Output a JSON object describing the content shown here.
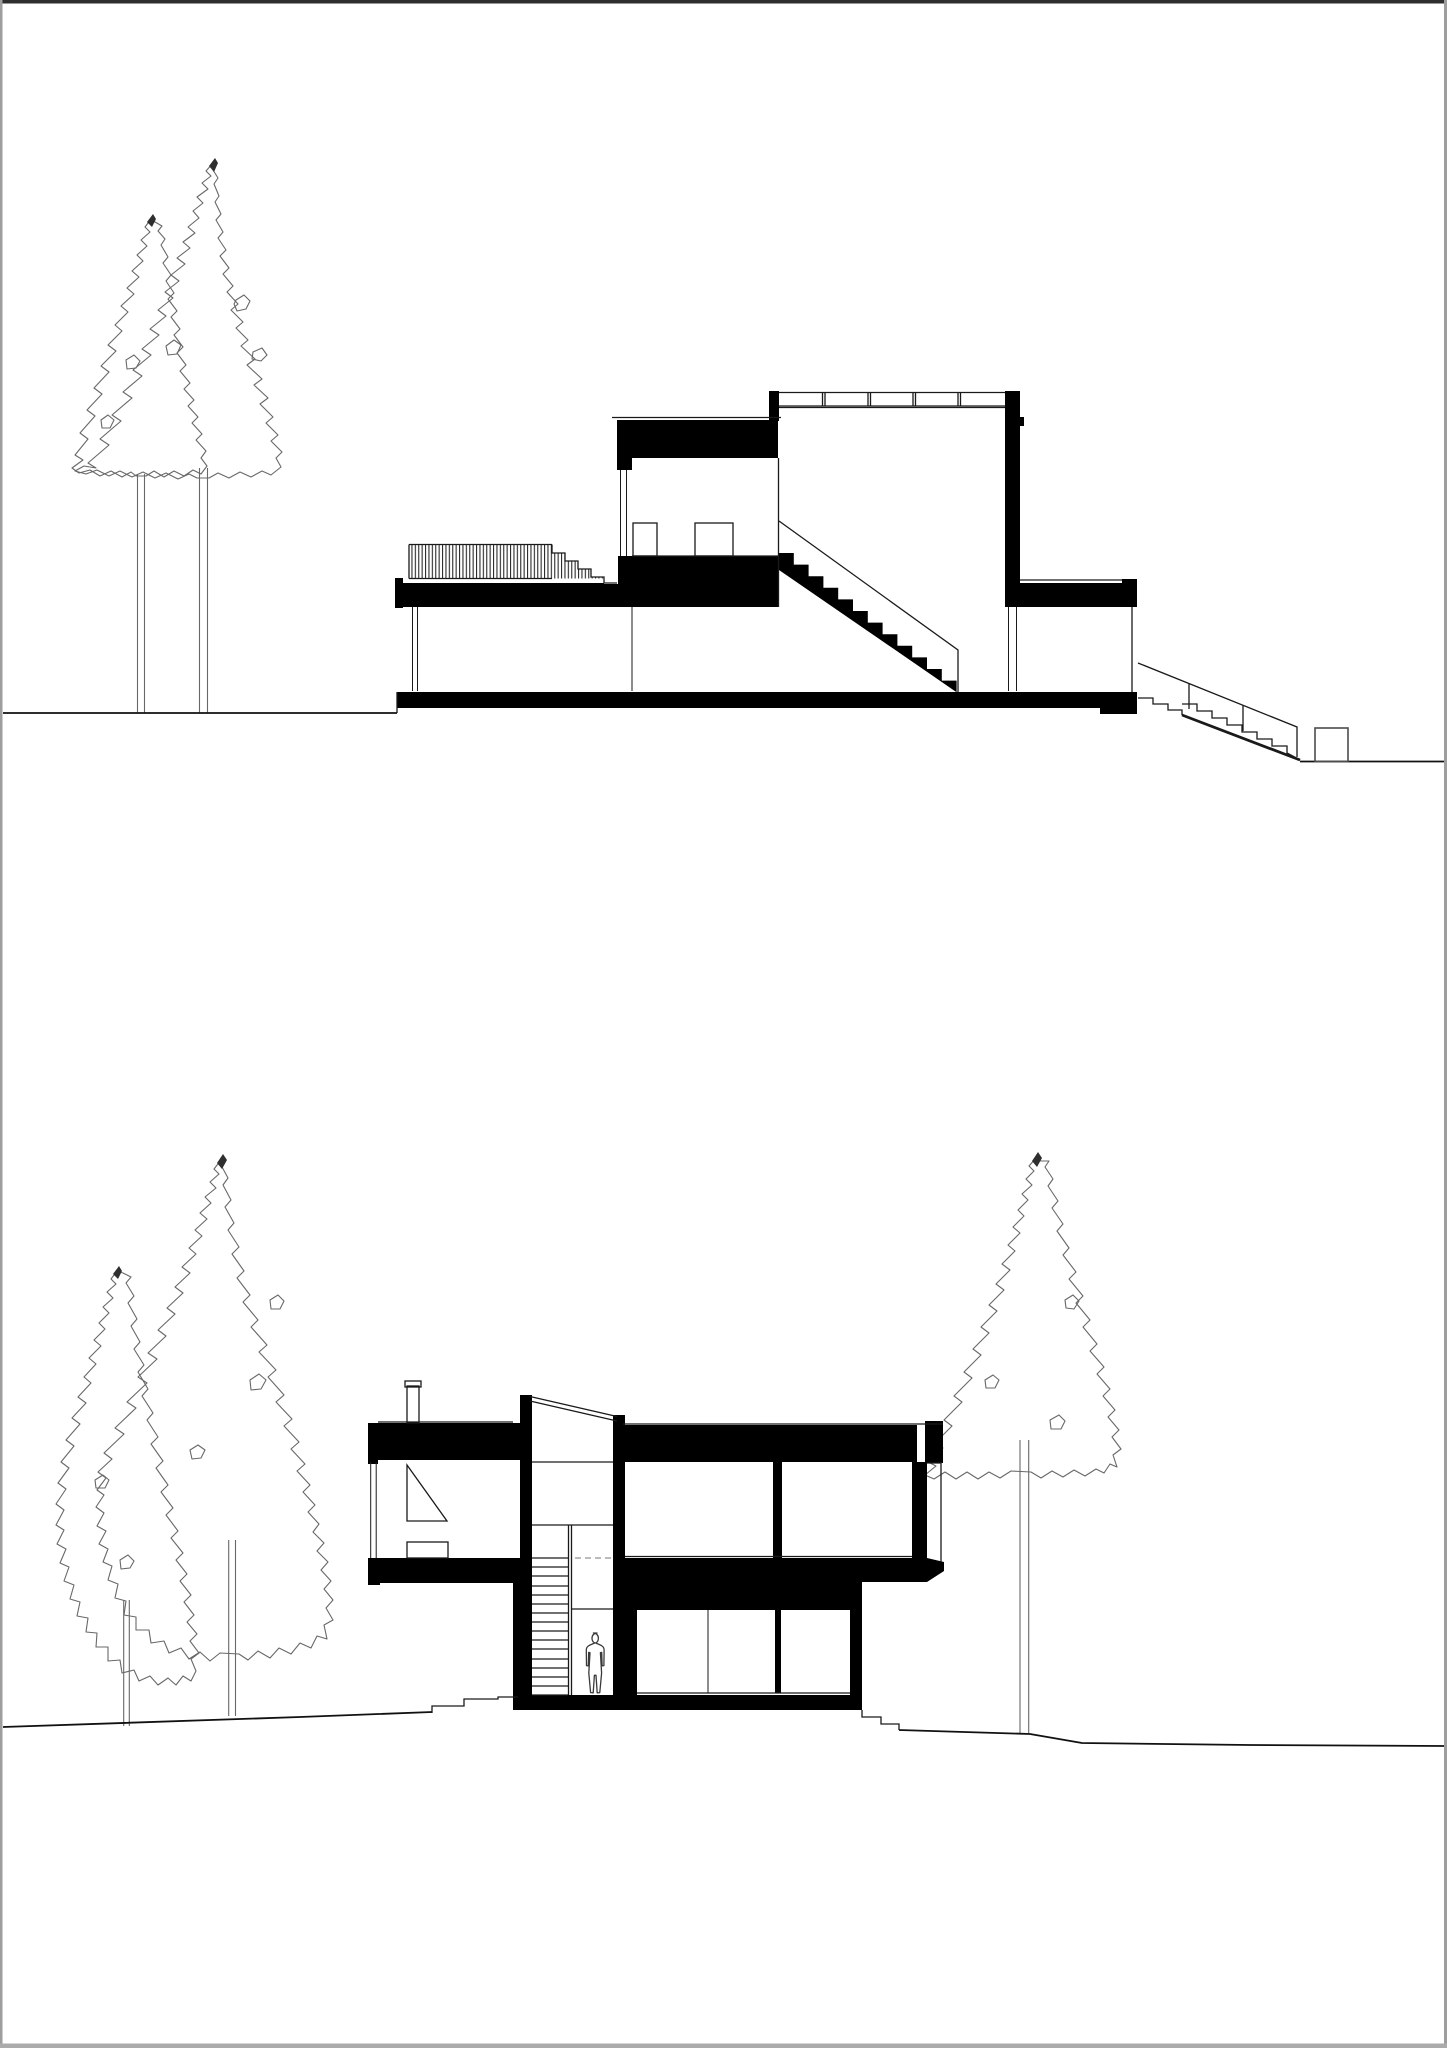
{
  "colors": {
    "paper": "#ffffff",
    "ink": "#000000",
    "line": "#1a1a1a",
    "ground": "#111111",
    "tree_line": "#686868",
    "tree_tip": "#2f2f2f",
    "hatch": "#2b2b2b",
    "figure": "#3a3a3a",
    "box_outline": "#4d4d4d",
    "dash": "#777777",
    "border_top": "#2e2e2e",
    "border_side": "#9e9e9e",
    "border_bottom": "#ababab"
  },
  "sheet": {
    "drawing_count": 2,
    "upper_section": {
      "tree_count": 2,
      "levels": 2,
      "has_exterior_ramp": true,
      "has_roof_railing": true,
      "has_hatched_deck": true
    },
    "lower_section": {
      "tree_count": 3,
      "levels": 2,
      "has_person_figure": true,
      "has_chimney": true,
      "has_interior_stair": true
    }
  }
}
